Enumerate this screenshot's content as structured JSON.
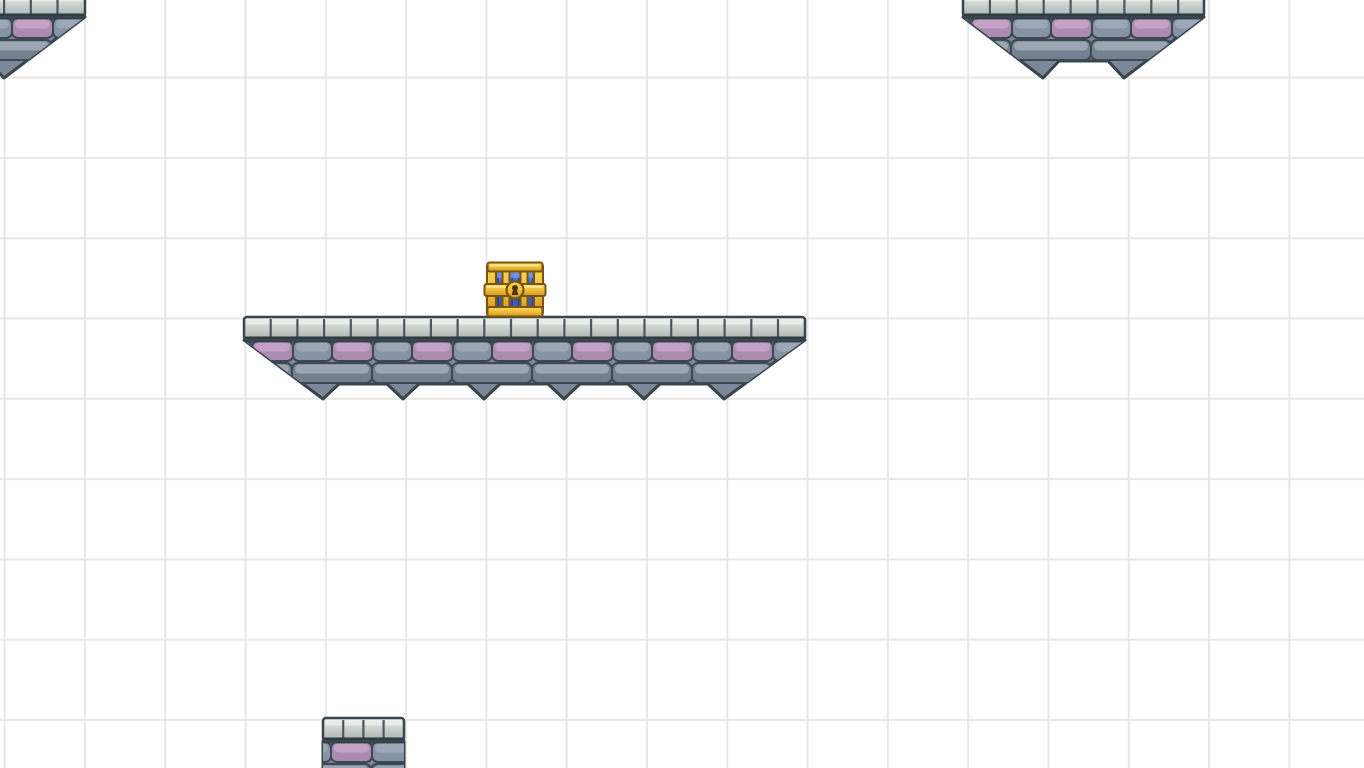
{
  "app": {
    "type": "2d-platformer-level-view",
    "description": "White level canvas with square grid, three floating castle-brick platforms with hanging spike undersides, one small brick pillar at the bottom edge, and a closed blue-and-gold treasure chest resting on the central bridge platform."
  },
  "canvas": {
    "width": 1364,
    "height": 768,
    "background": "#ffffff",
    "grid": {
      "cell": 80.3,
      "offset_x": 3.6,
      "offset_y": -3.7,
      "line_color": "#e7e7e8",
      "line_width": 2
    }
  },
  "palette": {
    "outline": "#39454d",
    "brick_base": "#7d8798",
    "brick_outline": "#3d4952",
    "brick_gray": "#8794a6",
    "brick_gray_hl": "#a0acbb",
    "brick_gray2": "#75808f",
    "brick_gray2_hl": "#a3acb9",
    "brick_pink": "#ad8bb0",
    "brick_pink_hl": "#c9a5ca",
    "spike_pink": "#bd98bf",
    "spike_shade": "#8d98a8",
    "cap_top": "#e8ece8",
    "cap_mid": "#cbd3ce",
    "cap_bottom": "#a7b2ae",
    "cap_joint": "#4a585e",
    "cap_outline": "#39464d",
    "cap_band": "#2e3b41",
    "chest": {
      "gold_light": "#ffe98c",
      "gold": "#f0bf3a",
      "gold_dark": "#cf9526",
      "gold_outline": "#7a5512",
      "blue": "#4a6ed0",
      "blue_light": "#7c9cec",
      "blue_dark": "#2a4494",
      "blue_outline": "#1c3066",
      "keyhole": "#4a3608"
    }
  },
  "level": {
    "platforms": [
      {
        "id": "platform-top-left",
        "style": "spiked",
        "left": -76,
        "top": -6,
        "width": 161,
        "cap_h": 23,
        "cap_stone_w": 26.7,
        "notch_y": 61,
        "tip_y": 78,
        "spike_tips": [
          4
        ],
        "left_edge": "cut",
        "right_edge": "slope"
      },
      {
        "id": "platform-top-right",
        "style": "spiked",
        "left": 963,
        "top": -6,
        "width": 241,
        "cap_h": 23,
        "cap_stone_w": 26.9,
        "notch_y": 61,
        "tip_y": 78,
        "spike_tips": [
          1043,
          1124
        ],
        "left_edge": "slope",
        "right_edge": "slope"
      },
      {
        "id": "platform-bridge",
        "style": "spiked",
        "left": 244,
        "top": 317,
        "width": 561,
        "cap_h": 23,
        "cap_stone_w": 26.7,
        "notch_y": 384,
        "tip_y": 399,
        "spike_tips": [
          323,
          403,
          484,
          564,
          644,
          724
        ],
        "left_edge": "slope",
        "right_edge": "slope"
      },
      {
        "id": "platform-bottom",
        "style": "pillar",
        "left": 323,
        "top": 718,
        "width": 81,
        "cap_h": 23,
        "cap_stone_w": 20.2,
        "bottom": 772,
        "left_edge": "cut",
        "right_edge": "cut"
      }
    ],
    "items": [
      {
        "id": "treasure-chest",
        "icon": "treasure-chest-icon",
        "x": 487,
        "y": 262,
        "width": 56,
        "height": 55
      }
    ]
  }
}
